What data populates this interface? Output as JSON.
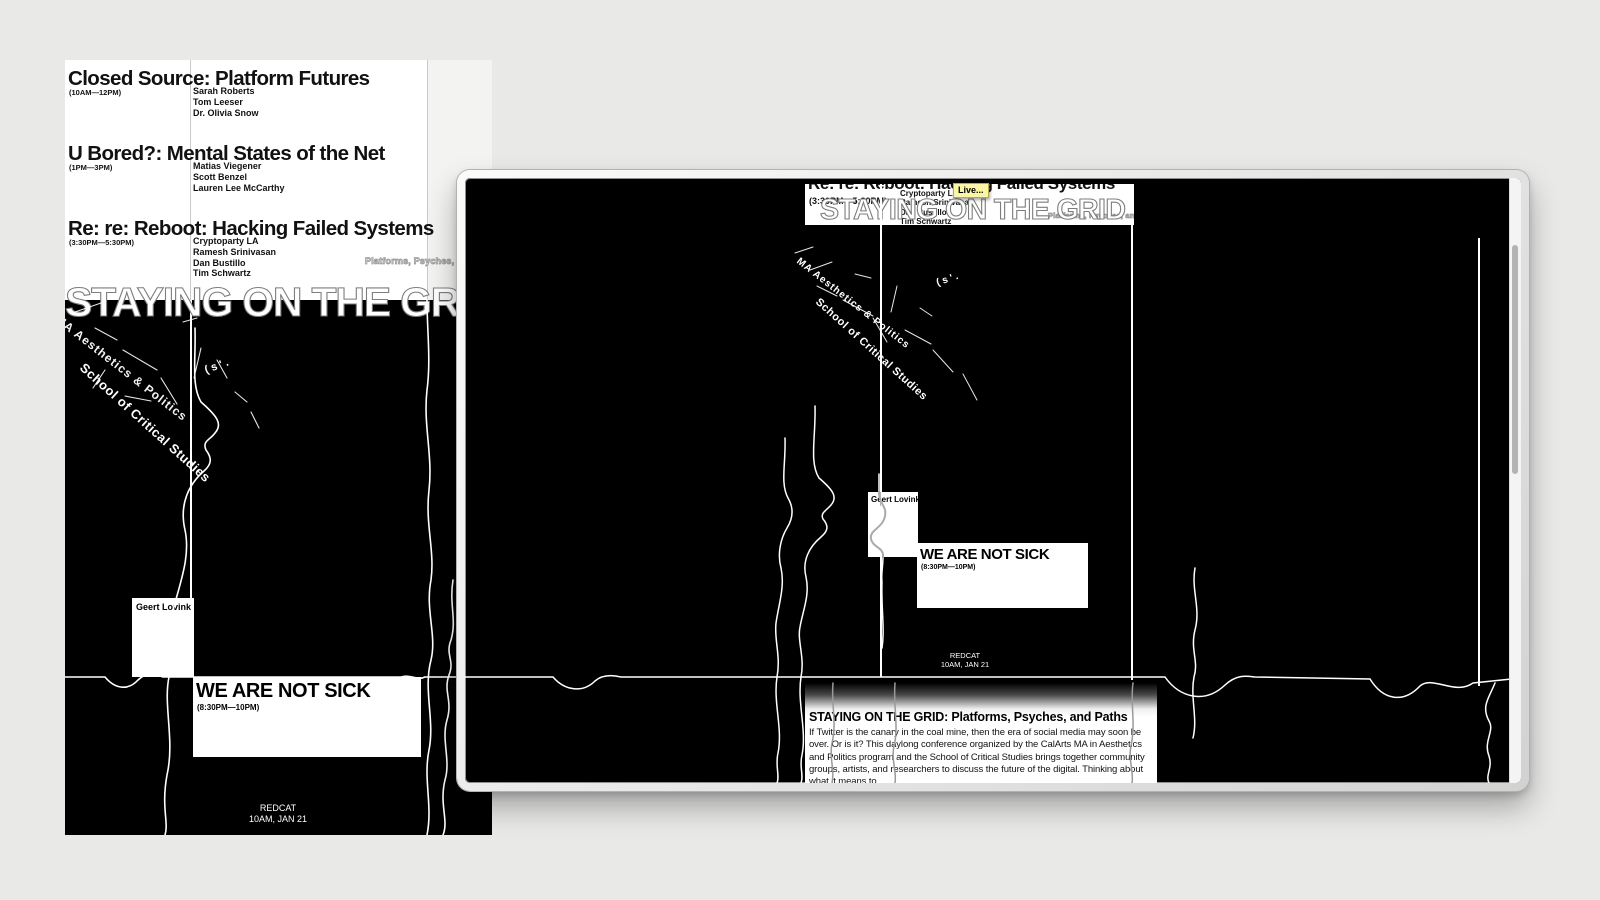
{
  "colors": {
    "canvas_bg": "#e9e9e7",
    "poster_black": "#000000",
    "poster_white": "#ffffff",
    "tooltip_bg": "#fbf5a6",
    "outline_gray": "#9a9a9a"
  },
  "poster": {
    "big_title": "STAYING ON THE GRID",
    "tagline": "Platforms, Psyches, and Paths",
    "sessions": [
      {
        "title": "Closed Source: Platform Futures",
        "time": "(10AM—12PM)",
        "speakers": [
          "Sarah Roberts",
          "Tom Leeser",
          "Dr. Olivia Snow"
        ]
      },
      {
        "title": "U Bored?: Mental States of the Net",
        "time": "(1PM—3PM)",
        "speakers": [
          "Matias Viegener",
          "Scott Benzel",
          "Lauren Lee McCarthy"
        ]
      },
      {
        "title": "Re: re: Reboot: Hacking Failed Systems",
        "time": "(3:30PM—5:30PM)",
        "speakers": [
          "Cryptoparty LA",
          "Ramesh Srinivasan",
          "Dan Bustillo",
          "Tim Schwartz"
        ]
      }
    ],
    "evening": {
      "speaker": "Geert Lovink",
      "title": "WE ARE NOT SICK",
      "time": "(8:30PM—10PM)"
    },
    "footer": {
      "venue": "REDCAT",
      "date": "10AM, JAN 21"
    },
    "scribbles": {
      "line1": "MA Aesthetics & Politics",
      "line2": "School of Critical Studies",
      "mark": "( s ' ."
    }
  },
  "panel": {
    "tooltip": "Live...",
    "description": {
      "heading": "STAYING ON THE GRID: Platforms, Psyches, and Paths",
      "body": "If Twitter is the canary in the coal mine, then the era of social media may soon be over. Or is it? This daylong conference organized by the CalArts MA in Aesthetics and Politics program and the School of Critical Studies brings together community groups, artists, and researchers to discuss the future of the digital. Thinking about what it means to"
    }
  }
}
